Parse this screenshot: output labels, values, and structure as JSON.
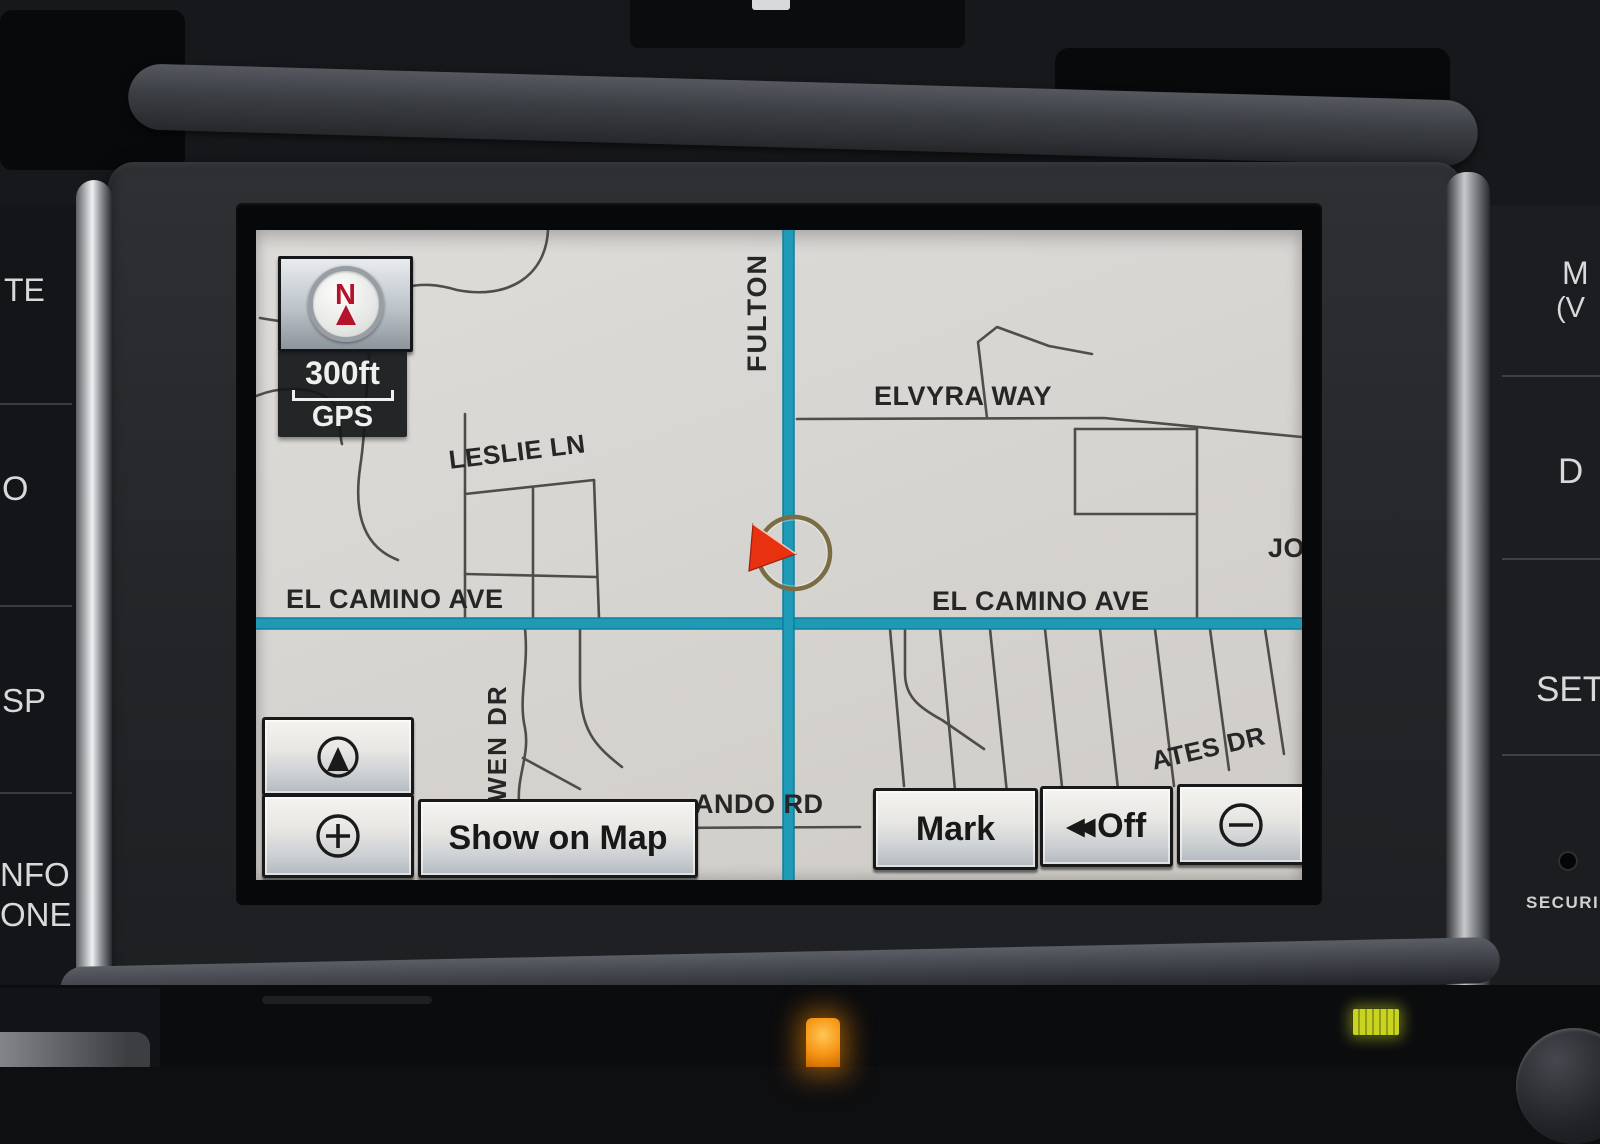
{
  "screen": {
    "compass": {
      "letter": "N"
    },
    "scale": {
      "distance": "300ft",
      "source": "GPS"
    },
    "streets": {
      "fulton": "FULTON",
      "elvyra_way": "ELVYRA WAY",
      "leslie_ln": "LESLIE LN",
      "el_camino_left": "EL CAMINO AVE",
      "el_camino_right": "EL CAMINO AVE",
      "gwen_dr": "GWEN DR",
      "ando_rd": "ANDO RD",
      "ates_dr": "ATES DR",
      "jo": "JO"
    },
    "controls": {
      "show_on_map": "Show on Map",
      "mark": "Mark",
      "off": "Off",
      "off_icon": "◀◀"
    },
    "colors": {
      "map_background": "#d8d6d2",
      "main_road": "#1e9ab6",
      "minor_road": "#44423f",
      "marker_red": "#e8320f"
    }
  },
  "hardware": {
    "left_fragments": [
      "TE",
      "O",
      "SP",
      "NFO",
      "ONE"
    ],
    "right_fragments": [
      "M",
      "(V",
      "D",
      "SET",
      "SECURI"
    ]
  }
}
